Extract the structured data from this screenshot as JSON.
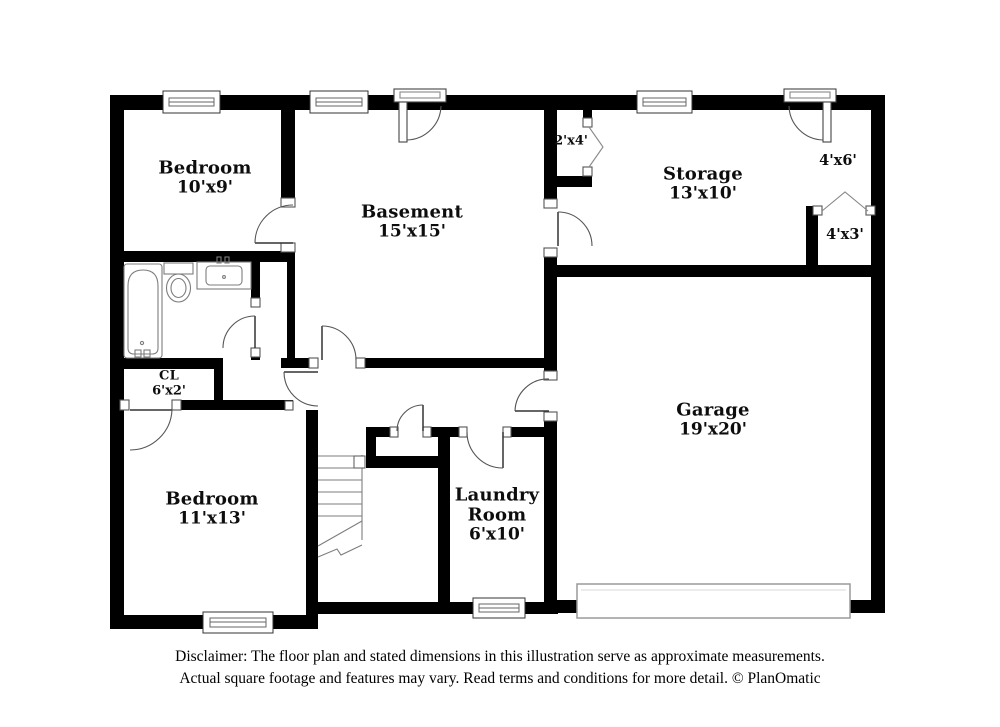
{
  "plan": {
    "rooms": {
      "bedroom1": {
        "name": "Bedroom",
        "dims": "10'x9'"
      },
      "basement": {
        "name": "Basement",
        "dims": "15'x15'"
      },
      "closet_2x4": {
        "dims": "2'x4'"
      },
      "storage": {
        "name": "Storage",
        "dims": "13'x10'"
      },
      "entry_4x6": {
        "dims": "4'x6'"
      },
      "closet_4x3": {
        "dims": "4'x3'"
      },
      "closet_cl": {
        "name": "CL",
        "dims": "6'x2'"
      },
      "bedroom2": {
        "name": "Bedroom",
        "dims": "11'x13'"
      },
      "laundry": {
        "name": "Laundry Room",
        "dims": "6'x10'"
      },
      "garage": {
        "name": "Garage",
        "dims": "19'x20'"
      }
    },
    "disclaimer": {
      "line1": "Disclaimer: The floor plan and stated dimensions in this illustration serve as approximate measurements.",
      "line2": "Actual square footage and features may vary. Read terms and conditions for more detail. © PlanOmatic"
    },
    "colors": {
      "wall": "#000000",
      "background": "#ffffff",
      "fixture_line": "#7d7d7d",
      "door_line": "#555555",
      "garage_door_line": "#9a9a9a"
    }
  }
}
